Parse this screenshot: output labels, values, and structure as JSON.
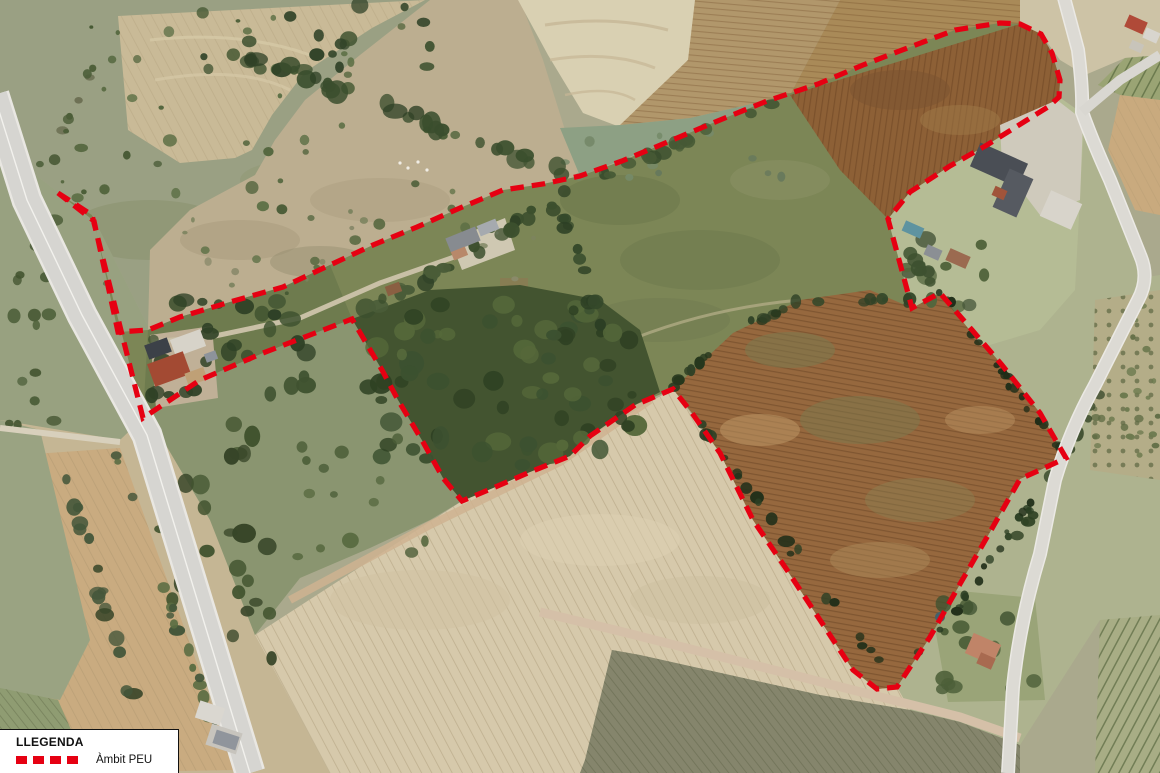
{
  "legend": {
    "title": "LLEGENDA",
    "items": [
      {
        "label": "Àmbit PEU",
        "symbol": "red-dashed-line",
        "color": "#e60012"
      }
    ]
  },
  "boundary": {
    "label": "Àmbit PEU",
    "color": "#e60012",
    "stroke_width": 5.2,
    "dash_pattern": [
      13.5,
      8
    ],
    "points": [
      [
        58,
        193
      ],
      [
        92,
        215
      ],
      [
        143,
        418
      ],
      [
        200,
        380
      ],
      [
        263,
        353
      ],
      [
        310,
        335
      ],
      [
        352,
        319
      ],
      [
        382,
        370
      ],
      [
        398,
        400
      ],
      [
        423,
        442
      ],
      [
        443,
        478
      ],
      [
        462,
        501
      ],
      [
        493,
        488
      ],
      [
        530,
        472
      ],
      [
        570,
        456
      ],
      [
        590,
        436
      ],
      [
        635,
        405
      ],
      [
        673,
        389
      ],
      [
        692,
        413
      ],
      [
        720,
        453
      ],
      [
        753,
        520
      ],
      [
        787,
        570
      ],
      [
        820,
        620
      ],
      [
        853,
        670
      ],
      [
        877,
        689
      ],
      [
        897,
        687
      ],
      [
        930,
        637
      ],
      [
        960,
        584
      ],
      [
        990,
        532
      ],
      [
        1020,
        479
      ],
      [
        1040,
        470
      ],
      [
        1066,
        458
      ],
      [
        1040,
        413
      ],
      [
        1002,
        365
      ],
      [
        972,
        330
      ],
      [
        940,
        293
      ],
      [
        912,
        308
      ],
      [
        888,
        219
      ],
      [
        910,
        192
      ],
      [
        950,
        166
      ],
      [
        987,
        145
      ],
      [
        1027,
        120
      ],
      [
        1048,
        107
      ],
      [
        1059,
        97
      ],
      [
        1060,
        80
      ],
      [
        1052,
        53
      ],
      [
        1041,
        34
      ],
      [
        1020,
        24
      ],
      [
        1000,
        23
      ],
      [
        955,
        30
      ],
      [
        910,
        47
      ],
      [
        863,
        65
      ],
      [
        818,
        84
      ],
      [
        767,
        101
      ],
      [
        720,
        120
      ],
      [
        670,
        141
      ],
      [
        622,
        161
      ],
      [
        580,
        176
      ],
      [
        543,
        184
      ],
      [
        503,
        190
      ],
      [
        460,
        208
      ],
      [
        417,
        227
      ],
      [
        373,
        245
      ],
      [
        330,
        265
      ],
      [
        283,
        287
      ],
      [
        230,
        302
      ],
      [
        180,
        317
      ],
      [
        148,
        330
      ],
      [
        118,
        332
      ],
      [
        94,
        221
      ]
    ]
  }
}
